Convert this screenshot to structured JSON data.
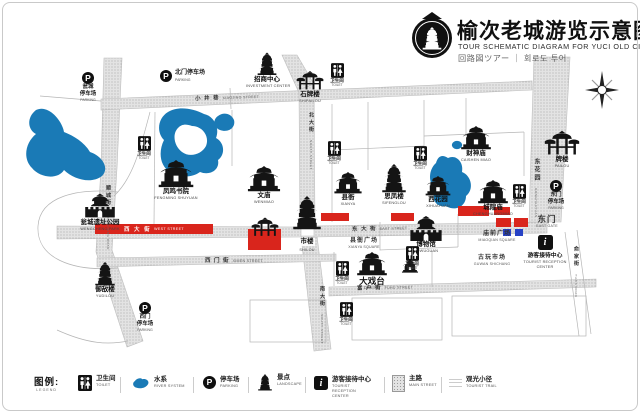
{
  "title": {
    "zh": "榆次老城游览示意图",
    "en": "TOUR SCHEMATIC DIAGRAM FOR YUCI OLD CITY",
    "translit": "回路図ツアー ｜ 회로도 투어"
  },
  "icons": {
    "parking": "P",
    "info": "i"
  },
  "colors": {
    "water": "#1a7ab6",
    "route": "#d9251c",
    "marker": "#2742c6"
  },
  "legend": {
    "heading_zh": "图例:",
    "heading_en": "LEGEND",
    "items": [
      {
        "zh": "卫生间",
        "en": "TOILET"
      },
      {
        "zh": "水系",
        "en": "RIVER SYSTEM"
      },
      {
        "zh": "停车场",
        "en": "PARKING"
      },
      {
        "zh": "景点",
        "en": "LANDSCAPE"
      },
      {
        "zh": "游客接待中心",
        "en": "TOURIST RECEPTION CENTER"
      },
      {
        "zh": "主路",
        "en": "MAIN STREET"
      },
      {
        "zh": "观光小径",
        "en": "TOURIST TRAIL"
      }
    ]
  },
  "streets": [
    {
      "zh": "小 井 巷",
      "en": "XIAOJING STREET"
    },
    {
      "zh": "西 大 街",
      "en": "WEST STREET"
    },
    {
      "zh": "东 大 街",
      "en": "EAST STREET"
    },
    {
      "zh": "西 门 街",
      "en": "XIMEN STREET"
    },
    {
      "zh": "富 户 街",
      "en": "FUHU STREET"
    },
    {
      "zh": "南大街",
      "en": "SOUTH STREET"
    },
    {
      "zh": "北大街",
      "en": "NORTH STREET"
    },
    {
      "zh": "俞家街",
      "en": "YUJIA ROAD"
    },
    {
      "zh": "顺城街",
      "en": "SHUNCHENG ROAD"
    }
  ],
  "pois": [
    {
      "zh": "凤鸣书院",
      "en": "FENGMING SHUYUAN"
    },
    {
      "zh": "文庙",
      "en": "WENMIAO"
    },
    {
      "zh": "县衙",
      "en": "XIANYA"
    },
    {
      "zh": "思凤楼",
      "en": "SIFENGLOU"
    },
    {
      "zh": "西花园",
      "en": "XIHUAYUAN"
    },
    {
      "zh": "城隍庙",
      "en": "CHENGHUANGMIAO"
    },
    {
      "zh": "财神庙",
      "en": "CAISHEN MIAO"
    },
    {
      "zh": "牌楼",
      "en": "PAILOU"
    },
    {
      "zh": "市楼",
      "en": "SHILOU"
    },
    {
      "zh": "博物馆",
      "en": "BOWUGUAN"
    },
    {
      "zh": "大戏台",
      "en": "DAXITAI"
    },
    {
      "zh": "瓮城遗址公园",
      "en": "WENGCHENG PARK"
    },
    {
      "zh": "御敌楼",
      "en": "YUDILOU"
    },
    {
      "zh": "石牌楼",
      "en": "SHIPAILOU"
    },
    {
      "zh": "招商中心",
      "en": "INVESTMENT CENTER"
    }
  ],
  "areas": [
    {
      "zh": "县衙广场",
      "en": "XIANYA SQUARE"
    },
    {
      "zh": "庙前广场",
      "en": "MIAOQIAN SQUARE"
    },
    {
      "zh": "古玩市场",
      "en": "GUWAN SHICHANG"
    },
    {
      "zh": "东门",
      "en": "EAST GATE"
    },
    {
      "zh": "东花园",
      "en": "DONGHUAYUAN"
    }
  ],
  "parkings": [
    {
      "l1": "瓮城",
      "l2": "停车场",
      "en": "PARKING"
    },
    {
      "l1": "北门停车场",
      "l2": "",
      "en": "PARKING"
    },
    {
      "l1": "东门",
      "l2": "停车场",
      "en": "PARKING"
    },
    {
      "l1": "西门",
      "l2": "停车场",
      "en": "PARKING"
    }
  ],
  "toilet": {
    "zh": "卫生间",
    "en": "TOILET"
  },
  "reception": {
    "zh": "游客接待中心",
    "en": "TOURIST RECEPTION CENTER"
  }
}
